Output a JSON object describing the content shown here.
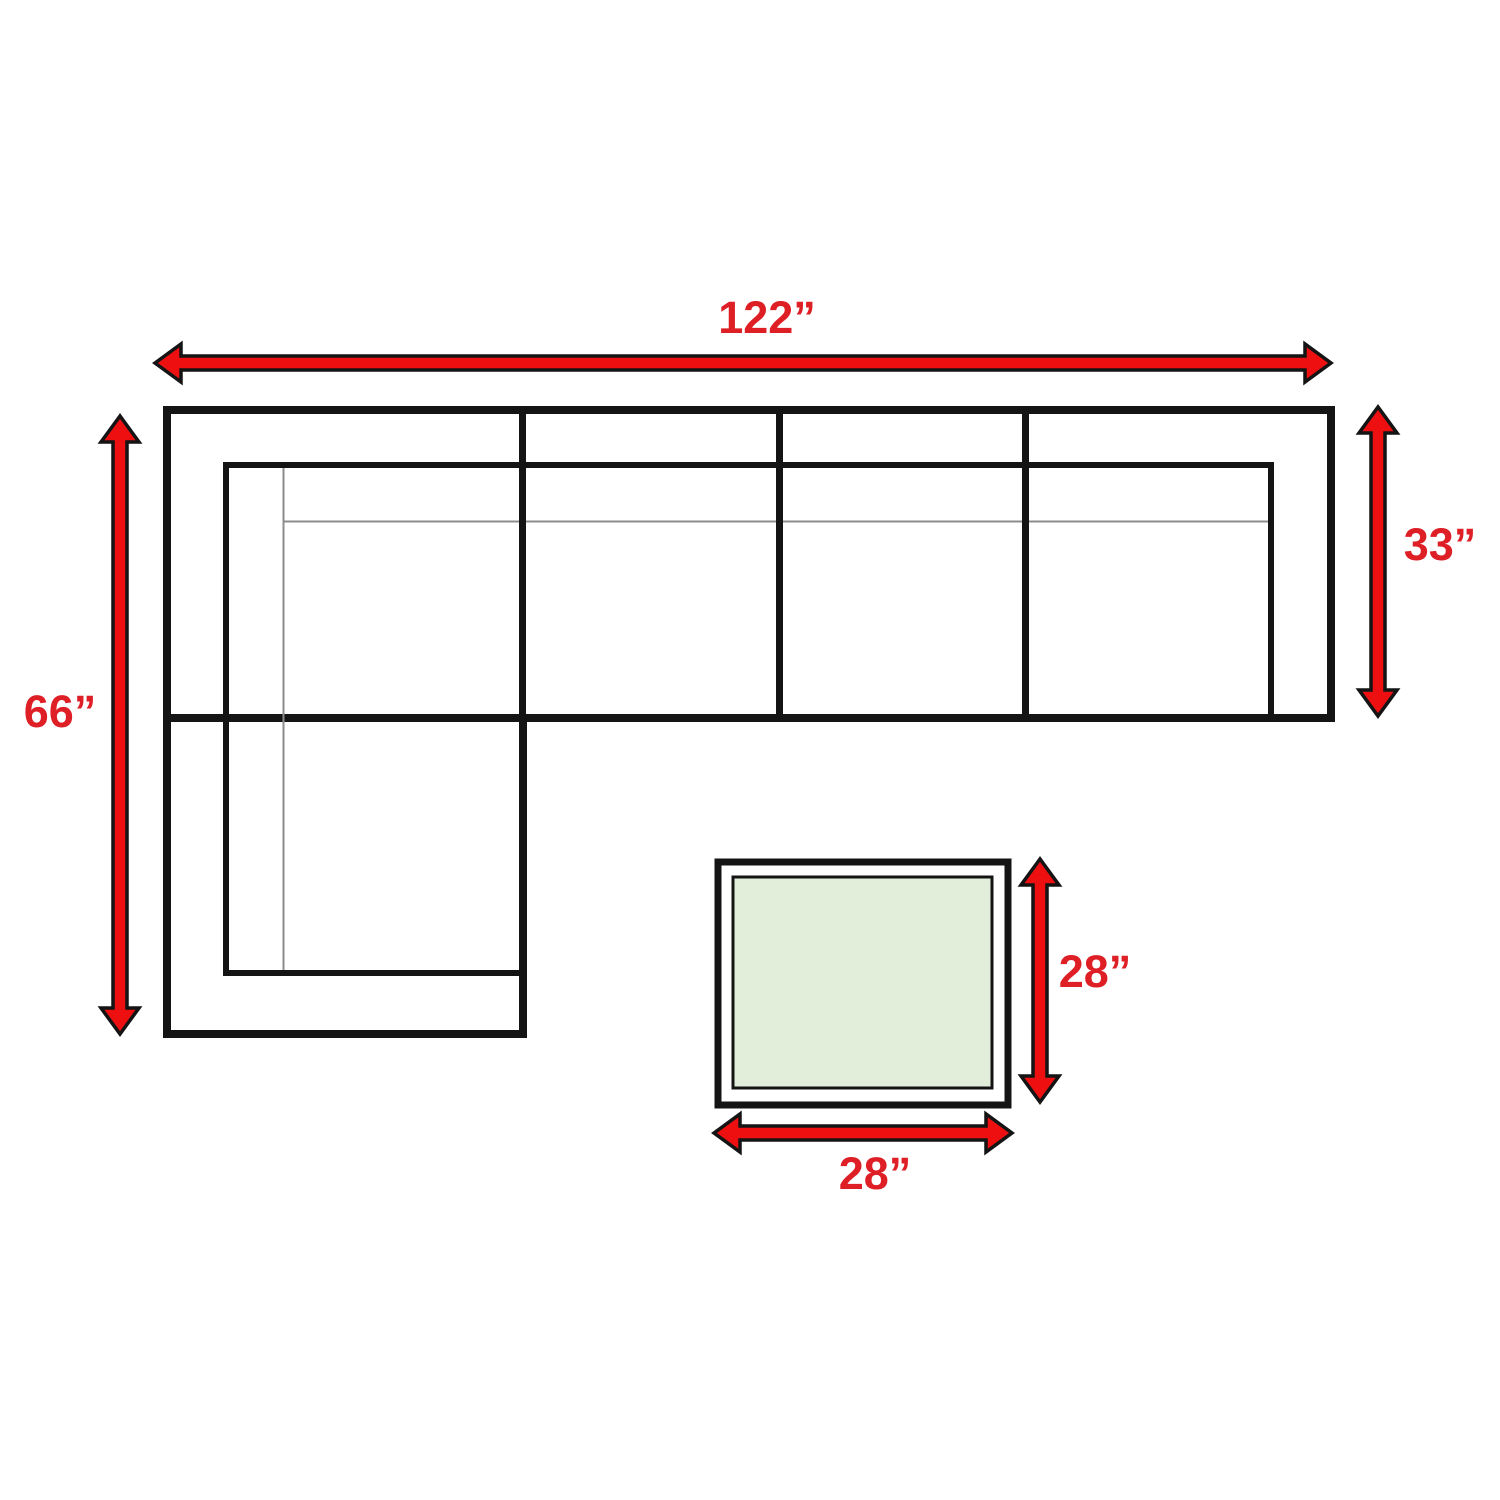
{
  "diagram": {
    "type": "furniture-dimension-diagram",
    "sofa": {
      "width_label": "122”",
      "left_depth_label": "66”",
      "right_depth_label": "33”"
    },
    "ottoman": {
      "depth_label": "28”",
      "width_label": "28”"
    }
  },
  "colors": {
    "arrow_red": "#ee1011",
    "label_red": "#de1f26",
    "line_black": "#141414",
    "thin_gray": "#8c8c8c",
    "ottoman_fill": "#e2eeda",
    "background": "#ffffff"
  }
}
